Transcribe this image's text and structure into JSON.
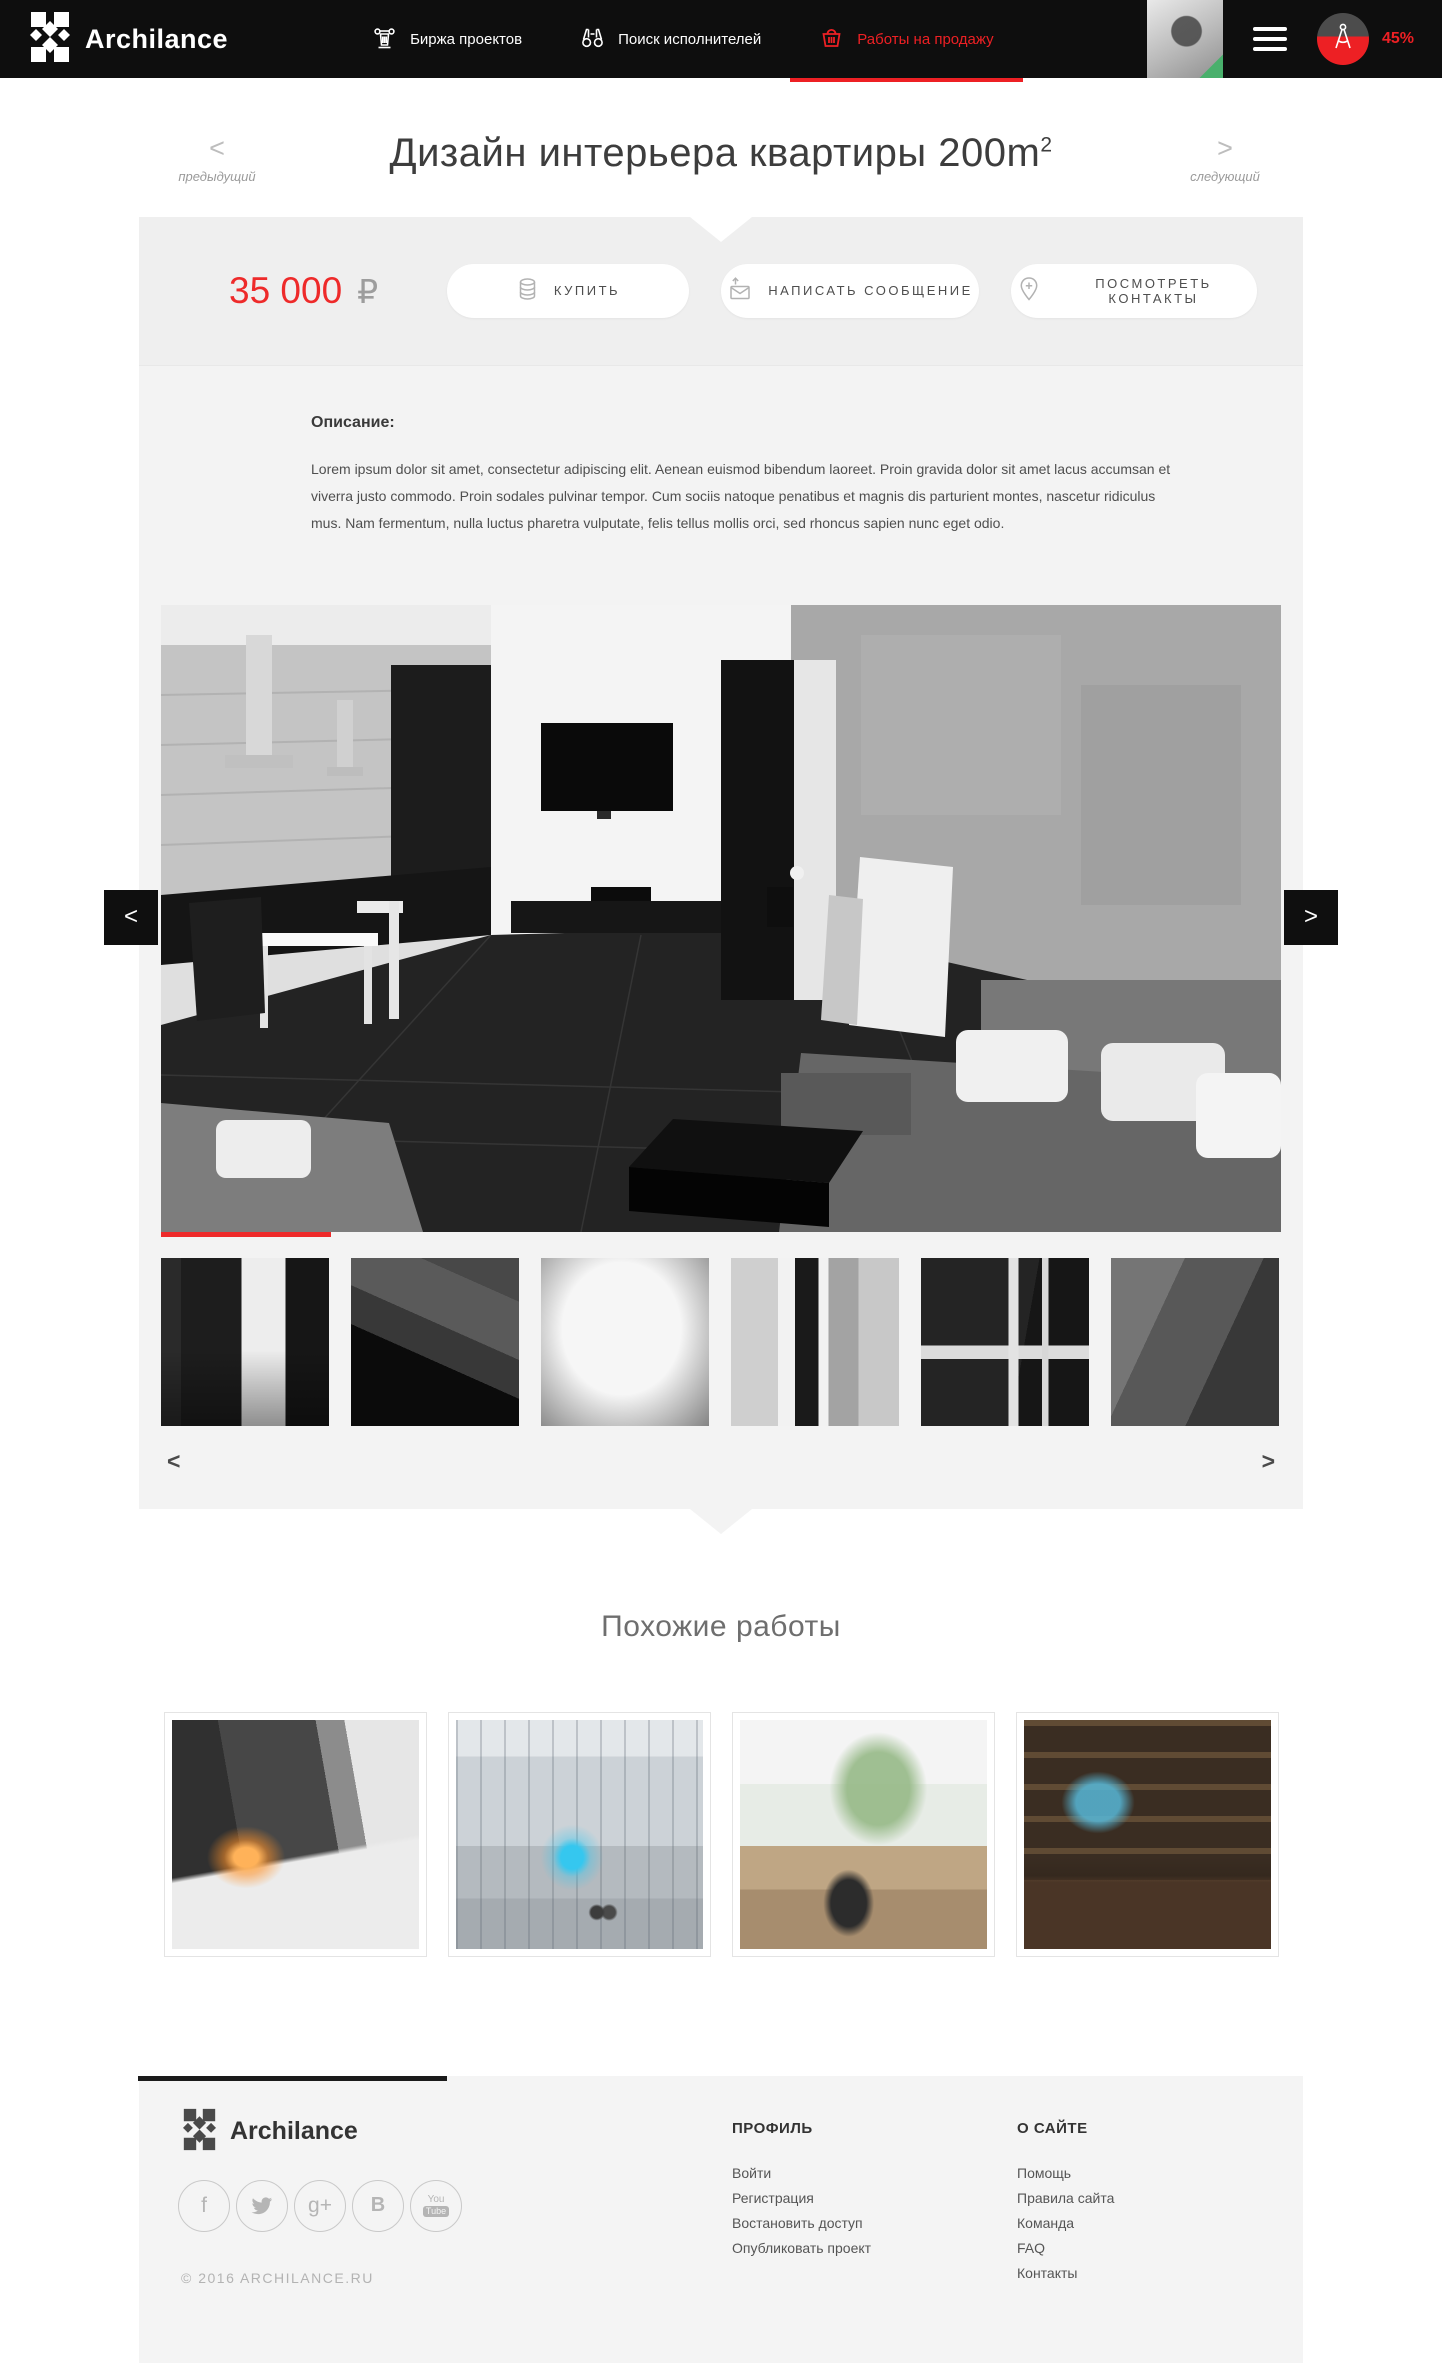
{
  "accent_color": "#ed2024",
  "header": {
    "brand": "Archilance",
    "nav": [
      {
        "label": "Биржа проектов",
        "icon": "bank-icon"
      },
      {
        "label": "Поиск исполнителей",
        "icon": "binoculars-icon"
      },
      {
        "label": "Работы на продажу",
        "icon": "basket-icon",
        "active": true
      }
    ],
    "progress_percent": "45%"
  },
  "title_bar": {
    "title": "Дизайн интерьера квартиры 200m",
    "title_sup": "2",
    "prev_arrow": "<",
    "prev_label": "предыдущий",
    "next_arrow": ">",
    "next_label": "следующий"
  },
  "price_bar": {
    "price": "35 000",
    "currency": "₽",
    "buy_label": "КУПИТЬ",
    "message_label": "НАПИСАТЬ СООБЩЕНИЕ",
    "contacts_label": "ПОСМОТРЕТЬ КОНТАКТЫ"
  },
  "description": {
    "heading": "Описание:",
    "body": "Lorem ipsum dolor sit amet, consectetur adipiscing elit. Aenean euismod bibendum laoreet. Proin gravida dolor sit amet lacus accumsan et viverra justo commodo. Proin sodales pulvinar tempor. Cum sociis natoque penatibus et magnis dis parturient montes, nascetur ridiculus mus. Nam fermentum, nulla luctus pharetra vulputate, felis tellus mollis orci, sed rhoncus sapien nunc eget odio."
  },
  "gallery": {
    "main_prev": "<",
    "main_next": ">",
    "strip_prev": "<",
    "strip_next": ">",
    "active_slide": 1,
    "thumb_count": 6
  },
  "similar": {
    "title": "Похожие работы",
    "card_count": 4
  },
  "footer": {
    "brand": "Archilance",
    "copyright": "© 2016 ARCHILANCE.RU",
    "social_glyphs": {
      "facebook": "f",
      "gplus": "g+",
      "vk": "B",
      "youtube_top": "You",
      "youtube_badge": "Tube"
    },
    "columns": {
      "profile": {
        "heading": "ПРОФИЛЬ",
        "links": [
          "Войти",
          "Регистрация",
          "Востановить доступ",
          "Опубликовать проект"
        ]
      },
      "about": {
        "heading": "О САЙТЕ",
        "links": [
          "Помощь",
          "Правила сайта",
          "Команда",
          "FAQ",
          "Контакты"
        ]
      }
    }
  }
}
